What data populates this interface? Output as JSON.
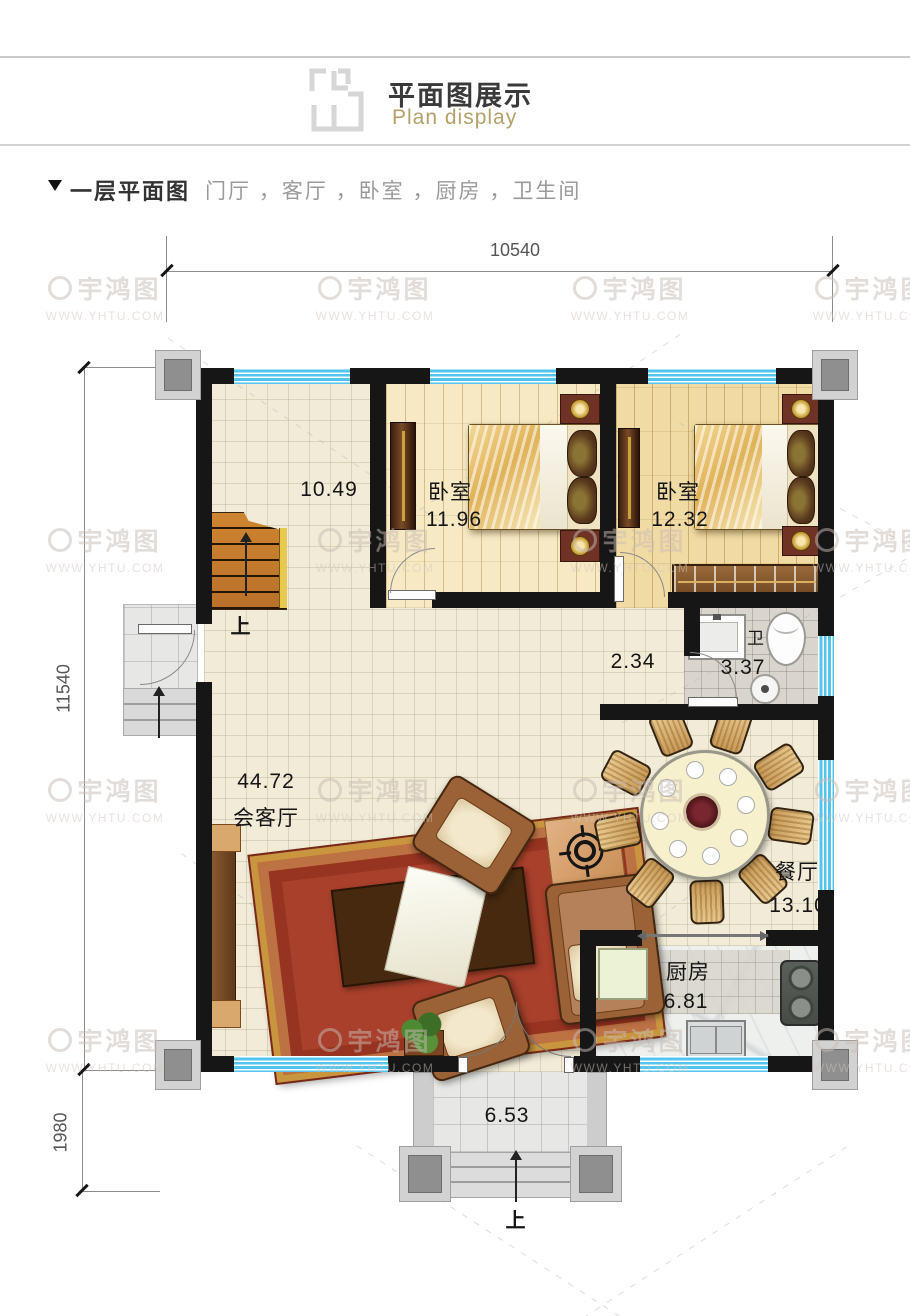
{
  "header": {
    "title": "平面图展示",
    "subtitle": "Plan display"
  },
  "section": {
    "title": "一层平面图",
    "subtitle": "门厅 ，客厅 ，卧室 ，厨房 ，卫生间"
  },
  "dimensions": {
    "top": "10540",
    "left": "11540",
    "bottom_left": "1980"
  },
  "rooms": {
    "hall": {
      "area": "10.49"
    },
    "bedroom1": {
      "name": "卧室",
      "area": "11.96"
    },
    "bedroom2": {
      "name": "卧室",
      "area": "12.32"
    },
    "corridor": {
      "area": "2.34"
    },
    "bathroom": {
      "name": "卫",
      "area": "3.37"
    },
    "living": {
      "name": "会客厅",
      "area": "44.72"
    },
    "dining": {
      "name": "餐厅",
      "area": "13.10"
    },
    "kitchen": {
      "name": "厨房",
      "area": "6.81"
    },
    "porch": {
      "area": "6.53"
    }
  },
  "annotations": {
    "up": "上"
  },
  "watermark": {
    "logo_text": "宇鸿图",
    "url": "WWW.YHTU.COM"
  },
  "colors": {
    "wall": "#161616",
    "window_blue": "#53c4ed",
    "title_gold": "#b5a06a",
    "carpet_red": "#a8402b",
    "stair_wood": "#c9812f",
    "dim_line": "#8d8d8d"
  }
}
